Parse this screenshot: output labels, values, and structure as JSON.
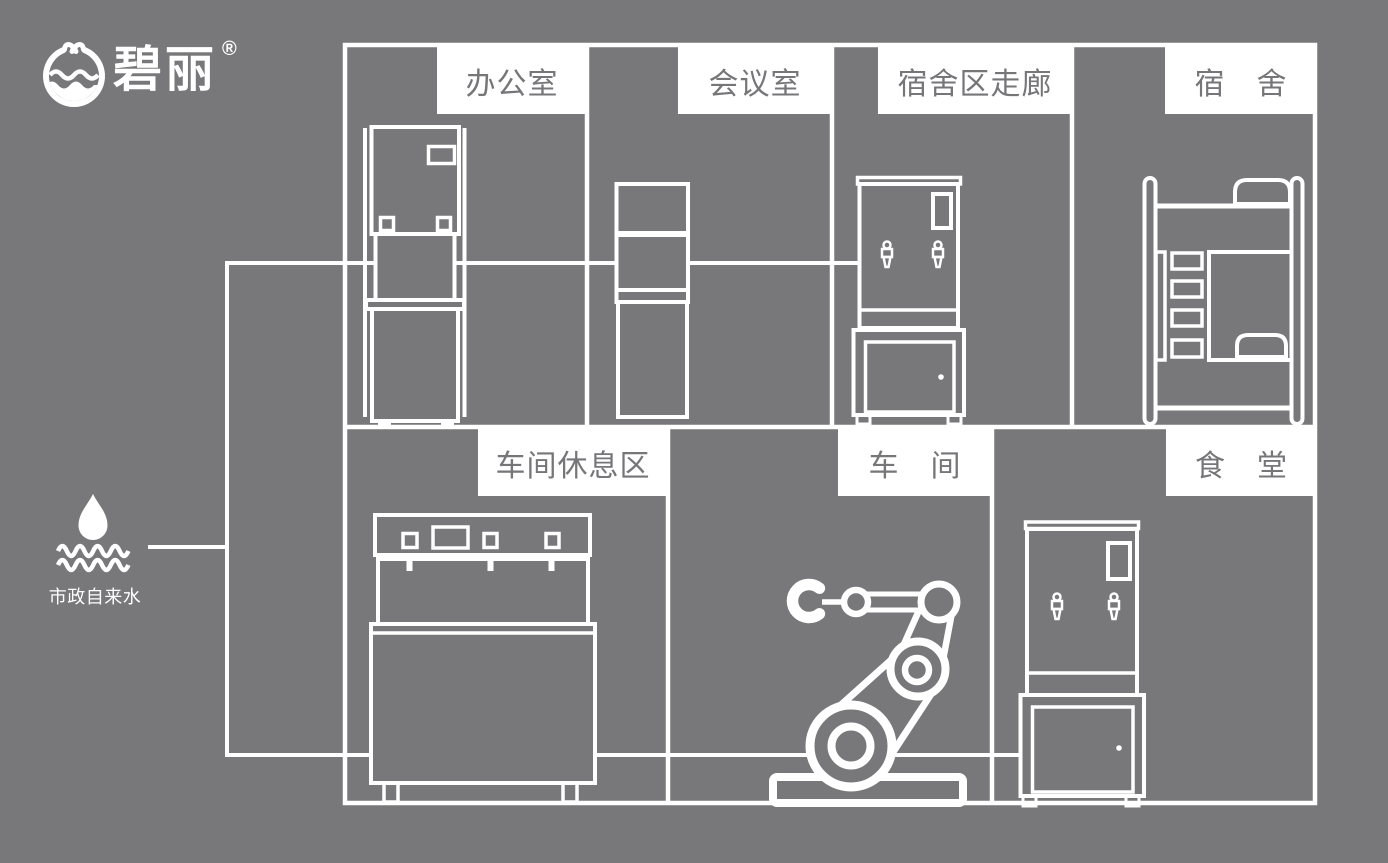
{
  "brand": {
    "name": "碧丽",
    "registered_mark": "®",
    "logo_icon": "water-cup-circle-logo"
  },
  "water_source": {
    "label": "市政自来水",
    "icon": "water-drop-waves-icon"
  },
  "rooms": {
    "office": "办公室",
    "meeting": "会议室",
    "corridor": "宿舍区走廊",
    "dorm": "宿　舍",
    "rest_area": "车间休息区",
    "workshop": "车　间",
    "canteen": "食　堂"
  },
  "equipment": {
    "office": "floor-standing-water-dispenser",
    "meeting": "slim-water-dispenser",
    "corridor": "water-boiler-on-cabinet",
    "dorm": "bunk-bed",
    "rest_area": "commercial-water-dispenser",
    "workshop": "robot-arm",
    "canteen": "water-boiler-on-cabinet"
  },
  "colors": {
    "background": "#787779",
    "line": "#ffffff",
    "label_background": "#ffffff",
    "label_text": "#767578"
  }
}
